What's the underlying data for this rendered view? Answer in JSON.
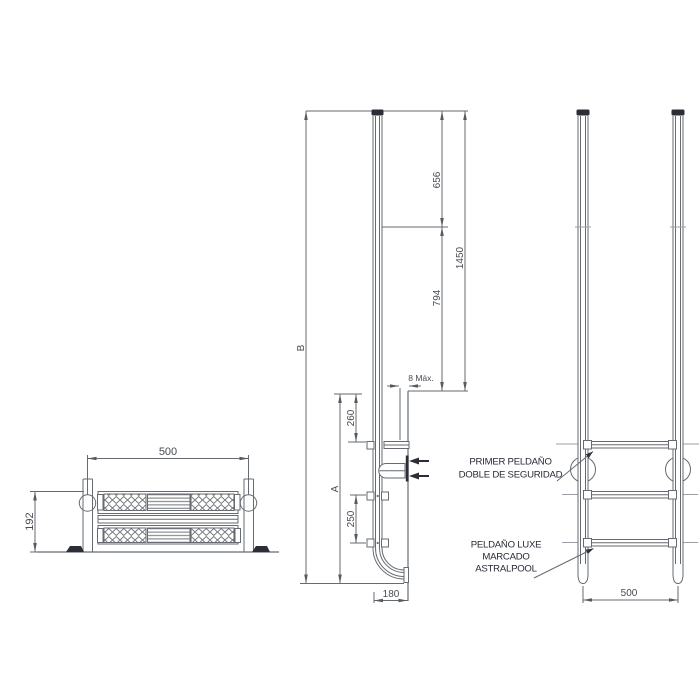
{
  "plan_view": {
    "width_mm": "500",
    "depth_mm": "192"
  },
  "side_view": {
    "overall_length": "B",
    "submerged_length": "A",
    "top_to_waterline": "656",
    "waterline_to_deck": "794",
    "top_to_deck": "1450",
    "deck_to_first_step": "260",
    "step_spacing": "250",
    "wall_clearance": "8 Máx.",
    "base_reach": "180"
  },
  "front_view": {
    "width_mm": "500",
    "callout_first_step": [
      "PRIMER PELDAÑO",
      "DOBLE DE SEGURIDAD"
    ],
    "callout_luxe_step": [
      "PELDAÑO LUXE",
      "MARCADO",
      "ASTRALPOOL"
    ]
  },
  "colors": {
    "line": "#666b72",
    "light_line": "#9aa0a6",
    "dim_text": "#474b52",
    "label_text": "#262a34",
    "dark": "#2b2e36",
    "background": "#ffffff"
  }
}
